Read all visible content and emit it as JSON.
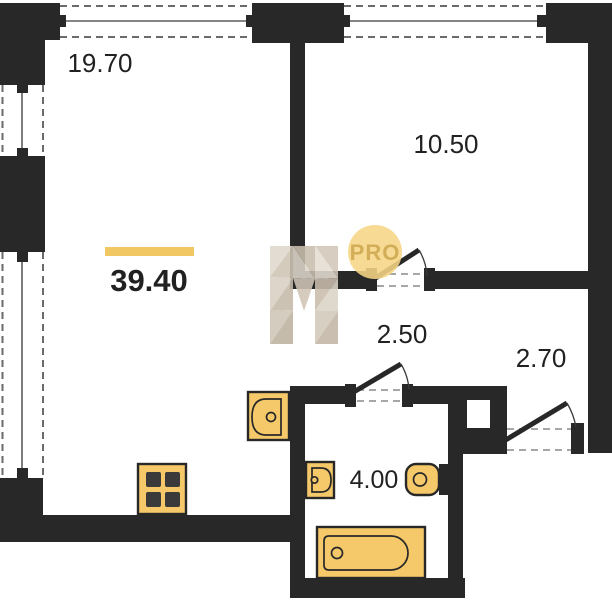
{
  "plan": {
    "total_area": "39.40",
    "rooms": {
      "living": {
        "area": "19.70"
      },
      "bedroom": {
        "area": "10.50"
      },
      "hallway": {
        "area": "2.50"
      },
      "entry": {
        "area": "2.70"
      },
      "bathroom": {
        "area": "4.00"
      }
    },
    "fixtures": [
      "stove",
      "kitchen-sink",
      "bathroom-sink",
      "toilet",
      "bathtub"
    ],
    "watermark": {
      "badge": "PRO",
      "logo": "N"
    },
    "colors": {
      "wall": "#282828",
      "fixture_fill": "#f5c869",
      "accent_bar": "#f0c763",
      "watermark_circle": "#f6d685",
      "watermark_text": "#d2ae58",
      "label_text": "#212121"
    }
  }
}
